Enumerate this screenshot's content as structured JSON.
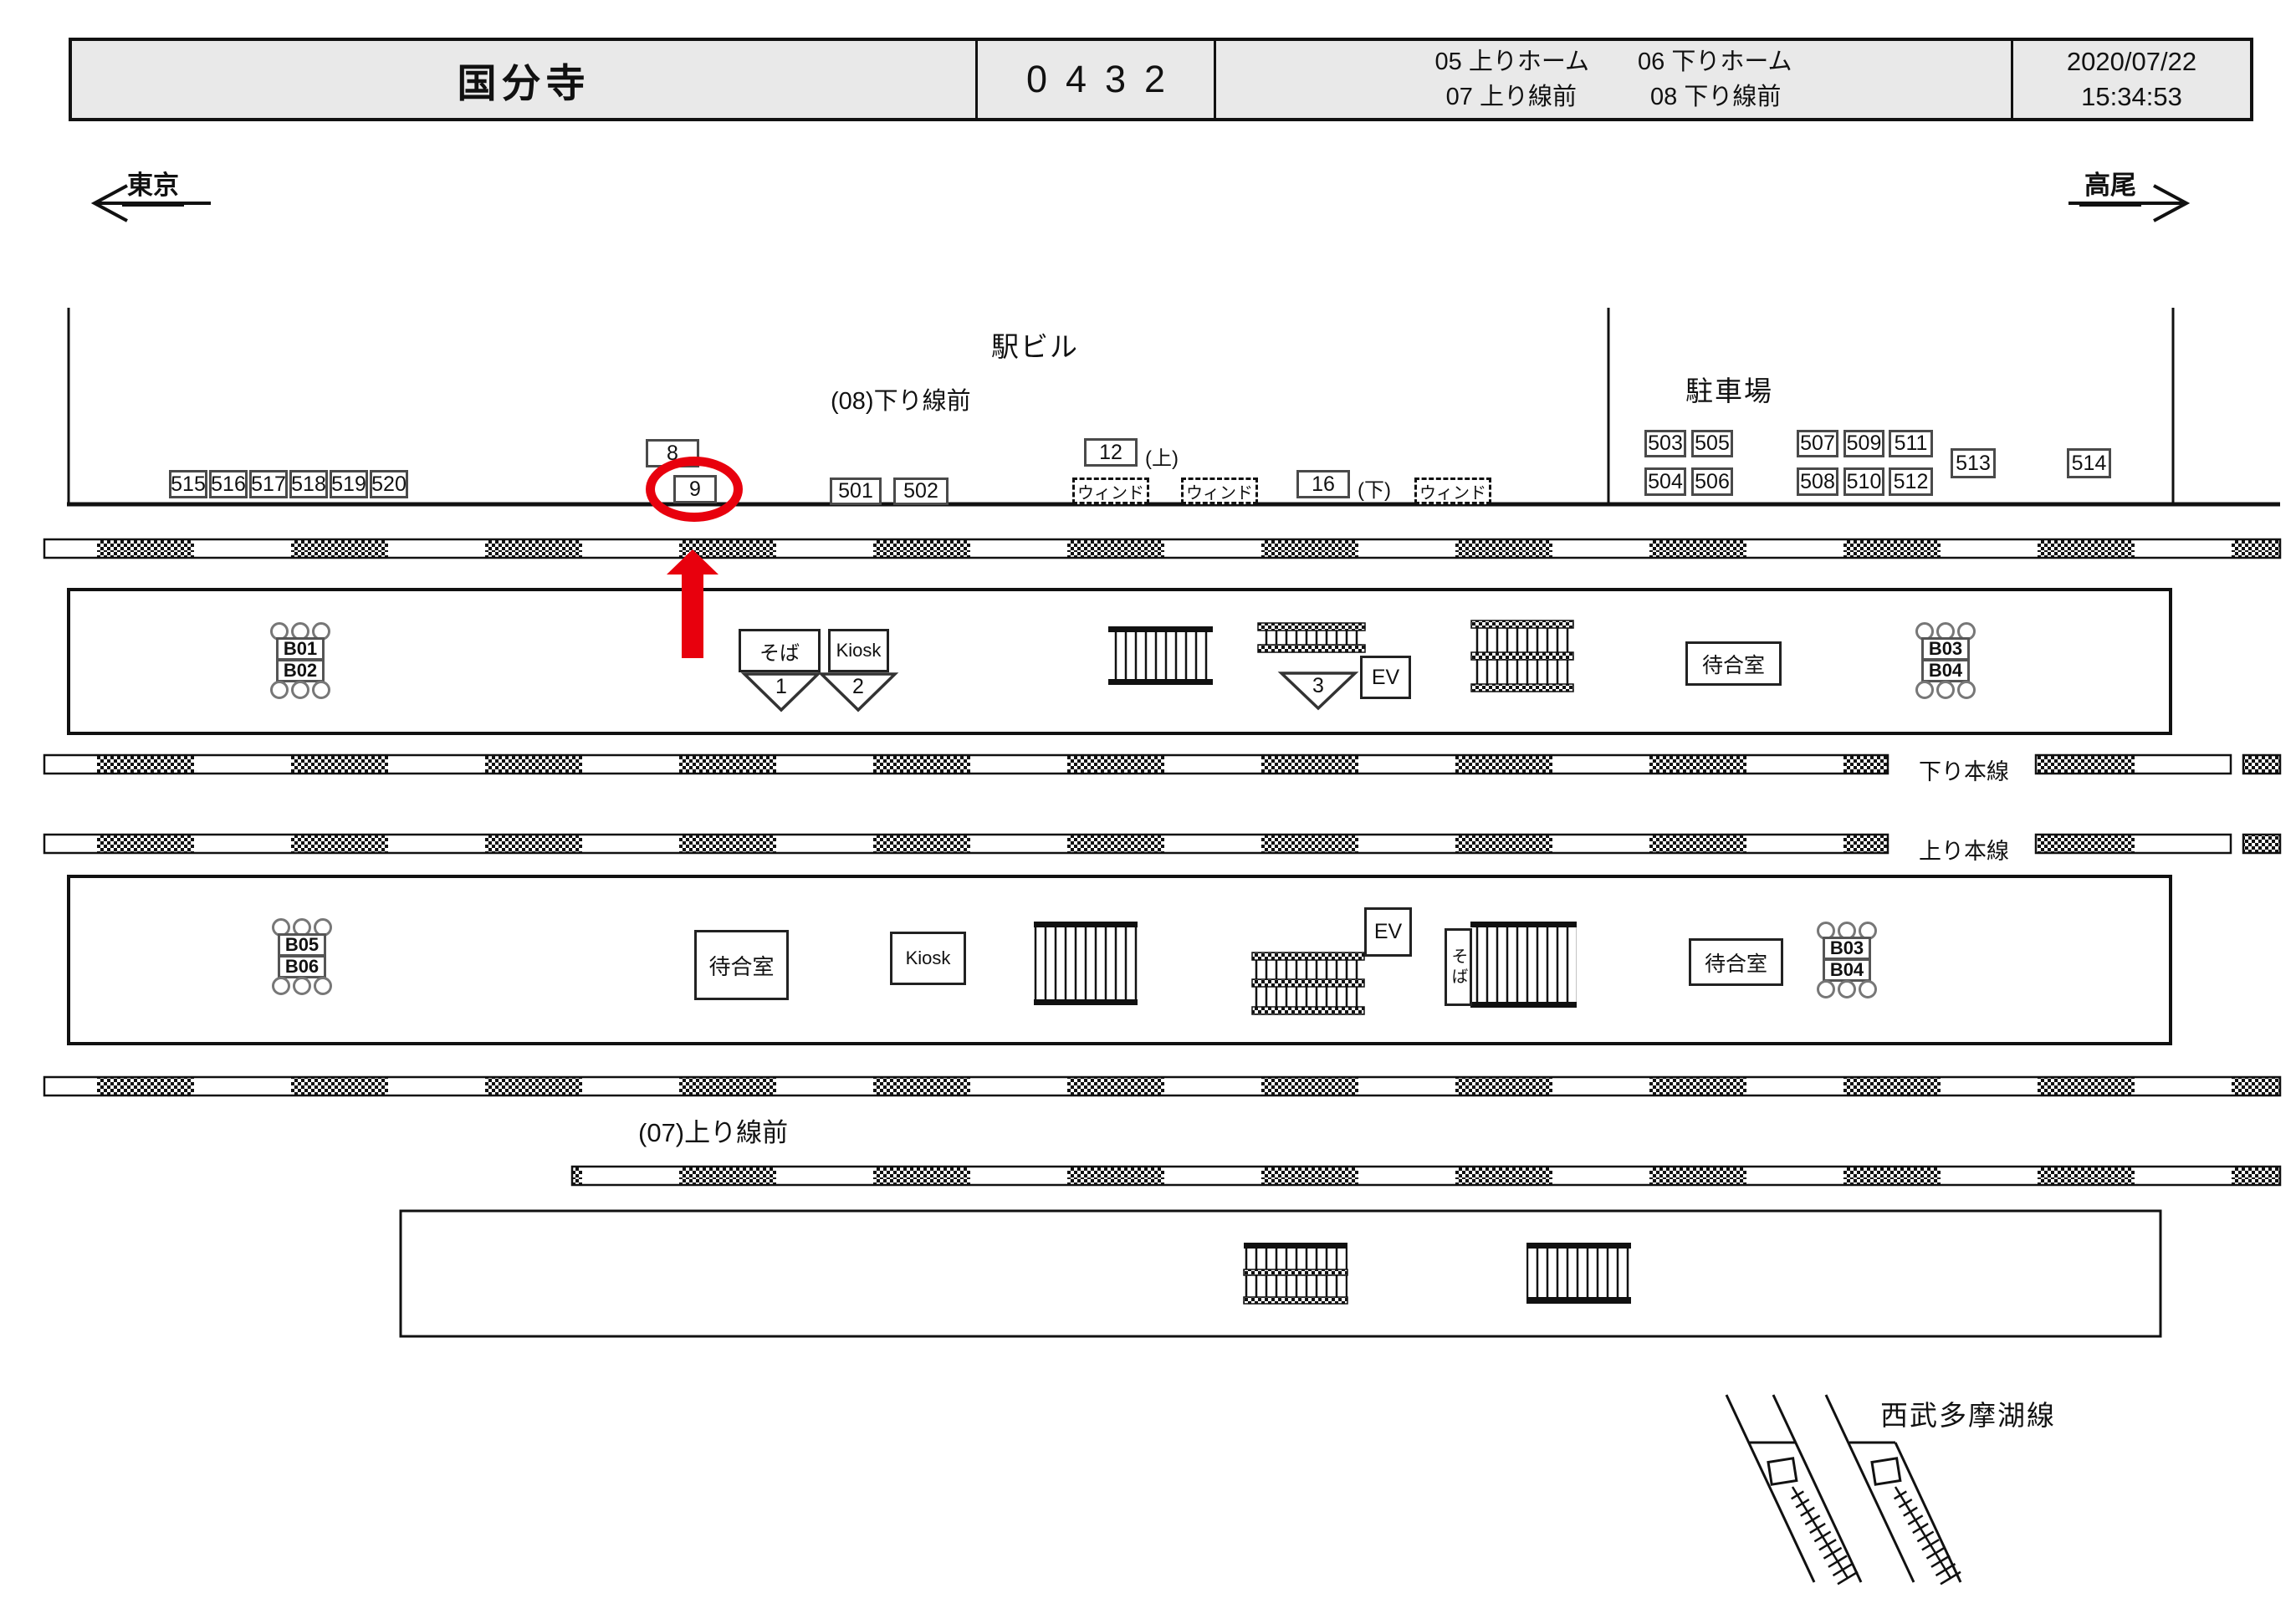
{
  "header": {
    "station": "国分寺",
    "code": "0432",
    "zone_refs": [
      "05 上りホーム",
      "06 下りホーム",
      "07  上り線前",
      "08 下り線前"
    ],
    "date": "2020/07/22",
    "time": "15:34:53"
  },
  "directions": {
    "left": "東京",
    "right": "高尾"
  },
  "building": {
    "title": "駅ビル",
    "zone_label": "(08)下り線前",
    "left_boxes": [
      "515",
      "516",
      "517",
      "518",
      "519",
      "520"
    ],
    "b8": "8",
    "b9": "9",
    "b501": "501",
    "b502": "502",
    "b12": "12",
    "tag_up": "(上)",
    "b16": "16",
    "tag_down": "(下)",
    "window_label": "ウィンド",
    "parking": {
      "title": "駐車場",
      "row1": [
        "503",
        "505",
        "507",
        "509",
        "511"
      ],
      "row2": [
        "504",
        "506",
        "508",
        "510",
        "512"
      ],
      "b513": "513",
      "b514": "514"
    }
  },
  "platform06": {
    "name": "(06)下りホーム",
    "berths_left": [
      "B01",
      "B02"
    ],
    "berths_right": [
      "B03",
      "B04"
    ],
    "soba": "そば",
    "kiosk": "Kiosk",
    "stair_numbers": [
      "1",
      "2",
      "3"
    ],
    "elevator": "EV",
    "waiting_room": "待合室"
  },
  "tracks": {
    "down_main": "下り本線",
    "up_main": "上り本線"
  },
  "platform05": {
    "name": "(05)上りホーム",
    "berths_left": [
      "B05",
      "B06"
    ],
    "berths_right": [
      "B03",
      "B04"
    ],
    "waiting_room_left": "待合室",
    "kiosk": "Kiosk",
    "elevator": "EV",
    "soba": "そば",
    "waiting_room_right": "待合室"
  },
  "zone07": "(07)上り線前",
  "seibu": {
    "kokubunji_line": "西武国分寺線",
    "tamako_line": "西武多摩湖線"
  }
}
